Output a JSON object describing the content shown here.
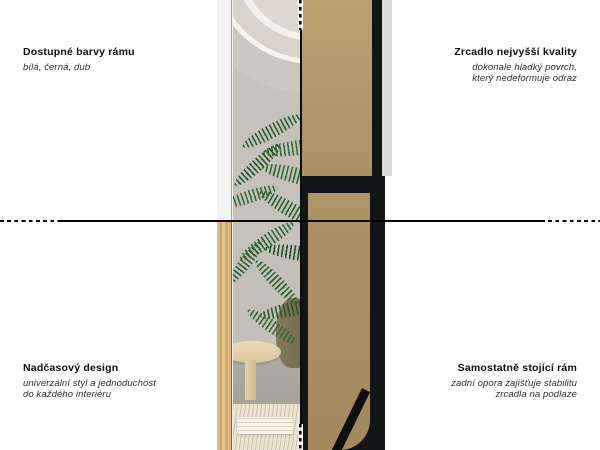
{
  "features": {
    "top_left": {
      "title": "Dostupné barvy rámu",
      "subtitle": "bílá, černá, dub"
    },
    "top_right": {
      "title": "Zrcadlo nejvyšší kvality",
      "subtitle_line1": "dokonale hladký povrch,",
      "subtitle_line2": "který nedeformuje odraz"
    },
    "bottom_left": {
      "title": "Nadčasový design",
      "subtitle_line1": "univerzální styl a jednoduchost",
      "subtitle_line2": "do každého interiéru"
    },
    "bottom_right": {
      "title": "Samostatně stojící rám",
      "subtitle_line1": "zadní opora zajišťuje stabilitu",
      "subtitle_line2": "zrcadla na podlaze"
    }
  },
  "palette": {
    "background": "#ffffff",
    "divider_line": "#000000",
    "frame_black": "#141517",
    "mdf_board": "#b0976a",
    "oak_frame": "#d9ae74",
    "white_frame": "#f4f3f1",
    "wall_grey": "#c3c0b9",
    "plant_green": "#2f6b31",
    "rug_cream": "#ece5d4"
  }
}
